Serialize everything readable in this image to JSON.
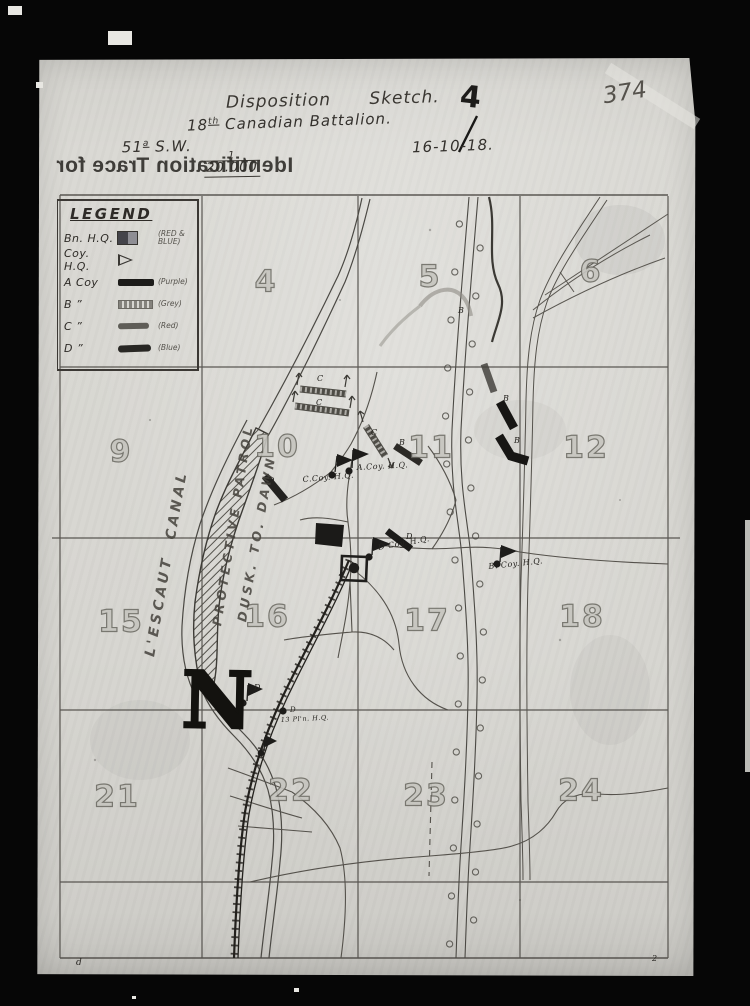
{
  "header": {
    "title": "Disposition      Sketch.",
    "copy_number": "4",
    "battalion_num": "18",
    "battalion_sup": "th",
    "battalion_rest": " Canadian Battalion.",
    "sheet_num": "51",
    "sheet_sup": "a",
    "sheet_rest": " S.W.",
    "scale_numerator": "1",
    "scale_denominator": "20.000",
    "date": "16-10-18.",
    "archive_number": "374",
    "mirrored_text": "Identification Trace for"
  },
  "legend": {
    "title": "LEGEND",
    "entries": [
      {
        "label": "Bn. H.Q.",
        "note": "(RED &\nBLUE)",
        "symbol": "square-red-blue"
      },
      {
        "label": "Coy. H.Q.",
        "note": "",
        "symbol": "flag"
      },
      {
        "label": "A Coy",
        "note": "(Purple)",
        "symbol": "bar-solid"
      },
      {
        "label": "B   ”",
        "note": "(Grey)",
        "symbol": "bar-hatched"
      },
      {
        "label": "C   ”",
        "note": "(Red)",
        "symbol": "bar-red"
      },
      {
        "label": "D   ”",
        "note": "(Blue)",
        "symbol": "bar-blue"
      }
    ]
  },
  "grid": {
    "squares": [
      {
        "label": "4",
        "x": 266,
        "y": 282
      },
      {
        "label": "5",
        "x": 430,
        "y": 277
      },
      {
        "label": "6",
        "x": 591,
        "y": 272
      },
      {
        "label": "9",
        "x": 121,
        "y": 452
      },
      {
        "label": "10",
        "x": 277,
        "y": 447
      },
      {
        "label": "11",
        "x": 431,
        "y": 448
      },
      {
        "label": "12",
        "x": 586,
        "y": 448
      },
      {
        "label": "15",
        "x": 121,
        "y": 622
      },
      {
        "label": "16",
        "x": 267,
        "y": 617
      },
      {
        "label": "17",
        "x": 427,
        "y": 621
      },
      {
        "label": "18",
        "x": 582,
        "y": 617
      },
      {
        "label": "21",
        "x": 117,
        "y": 797
      },
      {
        "label": "22",
        "x": 291,
        "y": 791
      },
      {
        "label": "23",
        "x": 426,
        "y": 796
      },
      {
        "label": "24",
        "x": 581,
        "y": 791
      }
    ]
  },
  "map_labels": [
    {
      "text": "L'ESCAUT  CANAL",
      "x": 158,
      "y": 642,
      "rot": -80,
      "size": 14,
      "cls": "pencil-label",
      "name": "canal-name-label"
    },
    {
      "text": "PROTECTIVE PATROL",
      "x": 224,
      "y": 612,
      "rot": -81,
      "size": 12.5,
      "cls": "pencil-label",
      "name": "protective-patrol-label"
    },
    {
      "text": "DUSK. TO. DAWN",
      "x": 249,
      "y": 608,
      "rot": -80,
      "size": 12.5,
      "cls": "pencil-label",
      "name": "dusk-to-dawn-label"
    },
    {
      "text": "C.Coy. H.Q.",
      "x": 303,
      "y": 475,
      "rot": -5,
      "size": 8,
      "cls": "hw-label",
      "name": "c-coy-hq-label"
    },
    {
      "text": "A.Coy. H.Q.",
      "x": 357,
      "y": 463,
      "rot": -3,
      "size": 8,
      "cls": "hw-label",
      "name": "a-coy-hq-label"
    },
    {
      "text": "D Coy. H.Q.",
      "x": 379,
      "y": 543,
      "rot": -10,
      "size": 8,
      "cls": "hw-label",
      "name": "d-coy-hq-label"
    },
    {
      "text": "B. Coy. H.Q.",
      "x": 489,
      "y": 562,
      "rot": -6,
      "size": 8,
      "cls": "hw-label",
      "name": "b-coy-hq-label"
    },
    {
      "text": "13 Pl'n. H.Q.",
      "x": 281,
      "y": 716,
      "rot": -3,
      "size": 6.5,
      "cls": "hw-label",
      "name": "platoon-13-hq-label"
    },
    {
      "text": "B",
      "x": 458,
      "y": 306,
      "rot": 0,
      "size": 8,
      "cls": "hw-label",
      "name": "b-platoon-letter"
    },
    {
      "text": "B",
      "x": 503,
      "y": 394,
      "rot": 0,
      "size": 8,
      "cls": "hw-label",
      "name": "b-platoon-letter"
    },
    {
      "text": "B",
      "x": 514,
      "y": 436,
      "rot": 0,
      "size": 8,
      "cls": "hw-label",
      "name": "b-platoon-letter"
    },
    {
      "text": "B",
      "x": 399,
      "y": 438,
      "rot": 0,
      "size": 8,
      "cls": "hw-label",
      "name": "b-platoon-letter"
    },
    {
      "text": "C",
      "x": 317,
      "y": 374,
      "rot": 0,
      "size": 8,
      "cls": "hw-label",
      "name": "c-platoon-letter"
    },
    {
      "text": "C",
      "x": 316,
      "y": 398,
      "rot": 0,
      "size": 8,
      "cls": "hw-label",
      "name": "c-platoon-letter"
    },
    {
      "text": "C",
      "x": 371,
      "y": 428,
      "rot": 0,
      "size": 8,
      "cls": "hw-label",
      "name": "c-platoon-letter"
    },
    {
      "text": "D",
      "x": 268,
      "y": 476,
      "rot": 0,
      "size": 8,
      "cls": "hw-label",
      "name": "d-platoon-letter"
    },
    {
      "text": "D",
      "x": 406,
      "y": 532,
      "rot": 0,
      "size": 8,
      "cls": "hw-label",
      "name": "d-platoon-letter"
    },
    {
      "text": "D",
      "x": 254,
      "y": 683,
      "rot": 0,
      "size": 8,
      "cls": "hw-label",
      "name": "d-platoon-letter"
    },
    {
      "text": "D",
      "x": 290,
      "y": 706,
      "rot": 0,
      "size": 7,
      "cls": "hw-label",
      "name": "d-platoon-letter"
    },
    {
      "text": "N",
      "x": 181,
      "y": 666,
      "rot": 1,
      "size": 78,
      "cls": "north-letter",
      "name": "north-indicator"
    },
    {
      "text": "d",
      "x": 76,
      "y": 958,
      "rot": 0,
      "size": 9,
      "cls": "hw-label",
      "name": "margin-mark-left"
    },
    {
      "text": "2",
      "x": 652,
      "y": 954,
      "rot": 0,
      "size": 8,
      "cls": "hw-label",
      "name": "margin-mark-right"
    }
  ]
}
